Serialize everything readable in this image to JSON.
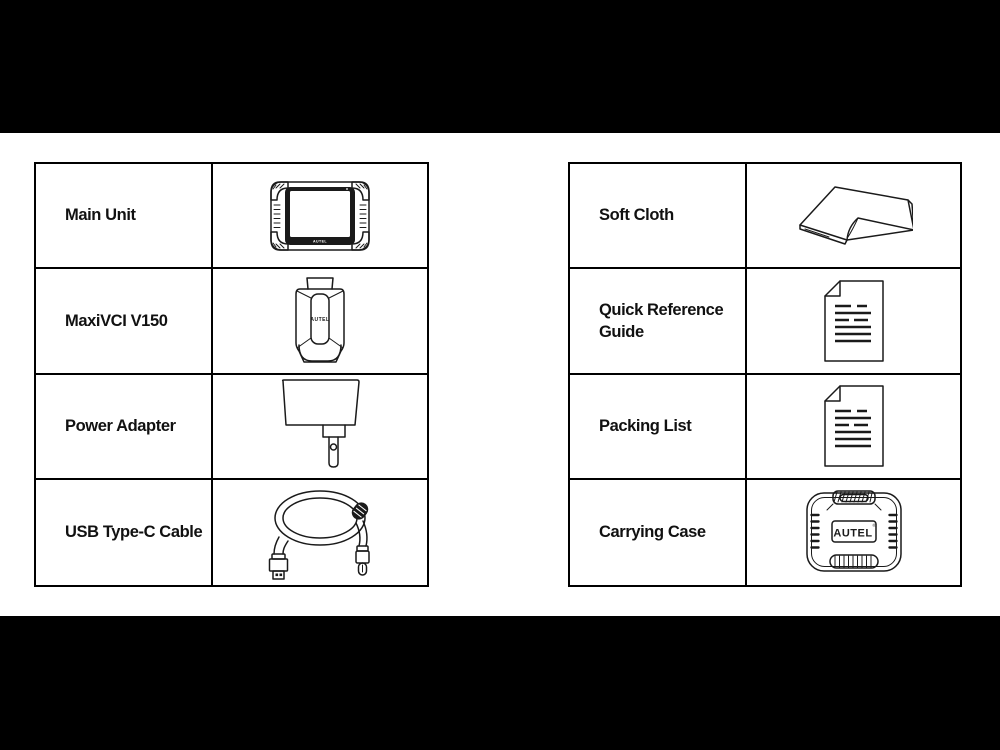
{
  "page": {
    "background": "#000000",
    "surface": "#ffffff",
    "line_color": "#1a1a1a"
  },
  "tables": {
    "left": {
      "rows": [
        {
          "label": "Main Unit",
          "icon": "main-unit-icon"
        },
        {
          "label": "MaxiVCI V150",
          "icon": "maxivci-v150-icon"
        },
        {
          "label": "Power Adapter",
          "icon": "power-adapter-icon"
        },
        {
          "label": "USB Type-C Cable",
          "icon": "usb-type-c-cable-icon"
        }
      ]
    },
    "right": {
      "rows": [
        {
          "label": "Soft Cloth",
          "icon": "soft-cloth-icon"
        },
        {
          "label": "Quick Reference Guide",
          "icon": "quick-reference-guide-icon"
        },
        {
          "label": "Packing List",
          "icon": "packing-list-icon"
        },
        {
          "label": "Carrying Case",
          "icon": "carrying-case-icon"
        }
      ]
    }
  },
  "brand": {
    "tablet": "AUTEL",
    "vci": "AUTEL",
    "case": "AUTEL",
    "case_reg": "®"
  }
}
